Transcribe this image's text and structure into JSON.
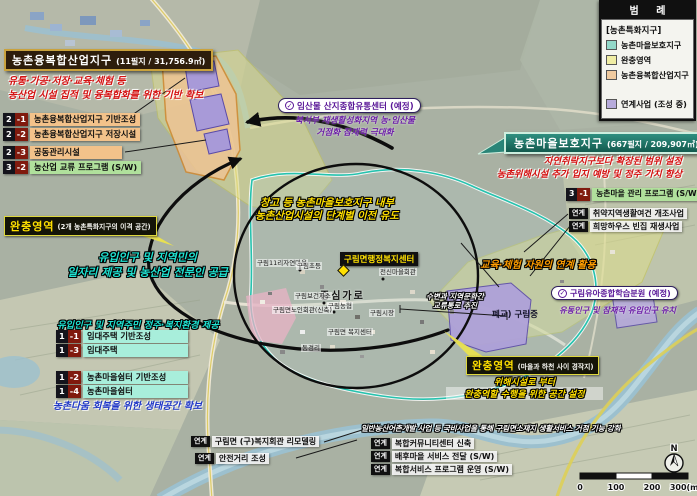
{
  "legend": {
    "title": "범 례",
    "group": "[농촌특화지구]",
    "items": [
      {
        "label": "농촌마을보호지구",
        "color": "#93d8c9"
      },
      {
        "label": "완충영역",
        "color": "#f0eda4"
      },
      {
        "label": "농촌융복합산업지구",
        "color": "#f1cba0"
      }
    ],
    "extra": {
      "label": "연계사업 (조성 중)",
      "color": "#b7abdb"
    }
  },
  "industrial": {
    "title": "농촌융복합산업지구",
    "area": "(11필지 / 31,756.9㎡)",
    "desc1": "유통·가공·저장·교육·체험 등",
    "desc2": "농산업 시설 집적 및 융복합화를 위한 기반 확보",
    "items": [
      {
        "num": "2",
        "sub": "-1",
        "label": "농촌융복합산업지구 기반조성"
      },
      {
        "num": "2",
        "sub": "-2",
        "label": "농촌융복합산업지구 저장시설"
      },
      {
        "num": "2",
        "sub": "-3",
        "label": "공동관리시설"
      },
      {
        "num": "3",
        "sub": "-2",
        "label": "농산업 교류 프로그램 (S/W)"
      }
    ]
  },
  "buffer_left": {
    "title": "완충영역",
    "subtitle": "(2개 농촌특화지구의 이격 공간)"
  },
  "supply": {
    "line1": "유입인구 및 지역민의",
    "line2": "일자리 제공 및 농산업 전문인 공급"
  },
  "welfare": {
    "heading": "유입인구 및 지역주민 정주·복지환경 제공",
    "items": [
      {
        "num": "1",
        "sub": "-1",
        "label": "임대주택 기반조성"
      },
      {
        "num": "1",
        "sub": "-3",
        "label": "임대주택"
      },
      {
        "num": "1",
        "sub": "-2",
        "label": "농촌마을쉼터 기반조성"
      },
      {
        "num": "1",
        "sub": "-4",
        "label": "농촌마을쉼터"
      }
    ],
    "note": "농촌다움 회복을 위한 생태공간 확보"
  },
  "links_left": [
    {
      "badge": "연계",
      "label": "구림면 (구)복지회관 리모델링"
    },
    {
      "badge": "연계",
      "label": "안전거리 조성"
    }
  ],
  "distribution": {
    "title": "임산물 산지종합유통센터 (예정)",
    "desc1": "북서부 재생활성화지역 농·임산물",
    "desc2": "거점화 잠재력 극대화"
  },
  "relocation": {
    "line1": "창고 등 농촌마을보호지구 내부",
    "line2": "농촌산업시설의 단계별 이전 유도"
  },
  "protection": {
    "title": "농촌마을보호지구",
    "area": "(667필지 / 209,907㎡)",
    "desc1": "자연취락지구보다 확장된 범위 설정",
    "desc2": "농촌위해시설 추가 입지 예방 및 정주 가치 향상",
    "item": {
      "num": "3",
      "sub": "-1",
      "label": "농촌마을 관리 프로그램 (S/W)"
    },
    "links": [
      {
        "badge": "연계",
        "label": "취약지역생활여건 개조사업"
      },
      {
        "badge": "연계",
        "label": "희망하우스 빈집 재생사업"
      }
    ]
  },
  "education": {
    "text": "교육·체험 자원의 연계 활용"
  },
  "learning": {
    "title": "구림유아종합학습분원 (예정)",
    "desc": "유동인구 및 잠재적 유입인구 유치"
  },
  "corridor": {
    "line1": "수변과 지역문화간",
    "line2": "교류통로 추진"
  },
  "buffer_right": {
    "title": "완충영역",
    "subtitle": "(마을과 하천 사이 경작지)",
    "desc1": "위해시설로 부터",
    "desc2": "완충역할 수행을 위한 공간 설정"
  },
  "banner": {
    "text": "일반농산어촌개발 사업 등 국비사업을 통해 구림면소재지 생활서비스 거점 기능 강화"
  },
  "links_right": [
    {
      "badge": "연계",
      "label": "복합커뮤니티센터 신축"
    },
    {
      "badge": "연계",
      "label": "배후마을 서비스 전달 (S/W)"
    },
    {
      "badge": "연계",
      "label": "복합서비스 프로그램 운영 (S/W)"
    }
  ],
  "map_labels": {
    "admin_center": "구림면행정복지센터",
    "main_street": "중심가로",
    "school": "폐교) 구림중",
    "pois": [
      {
        "label": "구림11리자연마을"
      },
      {
        "label": "구림초등"
      },
      {
        "label": "전신마을회관"
      },
      {
        "label": "구림보건지소"
      },
      {
        "label": "구림농협"
      },
      {
        "label": "구림면노인회관(신축)"
      },
      {
        "label": "구림시장"
      },
      {
        "label": "구림면 복지센터"
      },
      {
        "label": "동경리"
      }
    ]
  },
  "scale": {
    "ticks": [
      "0",
      "100",
      "200",
      "300(m)"
    ],
    "compass": "N"
  },
  "colors": {
    "protection_zone": "#2ab8a8",
    "buffer_zone": "#dede8c",
    "industrial_zone": "#eec494",
    "linked_project": "#a89ad8",
    "highlight_yellow": "#ffe000",
    "note_cyan": "#1fe3d2",
    "note_purple": "#6d1fa8",
    "note_red": "#d40f0f"
  }
}
